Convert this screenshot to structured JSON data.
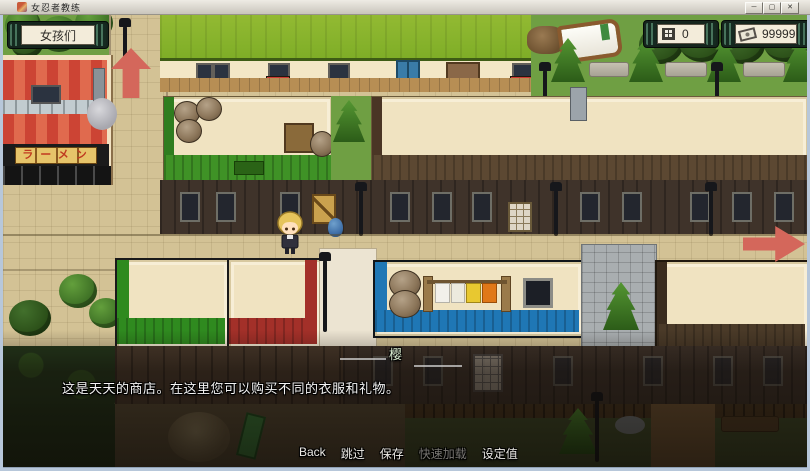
{
  "window": {
    "title": "女忍者教练",
    "minimize_glyph": "─",
    "maximize_glyph": "▢",
    "close_glyph": "✕"
  },
  "hud": {
    "girls_button_label": "女孩们",
    "day_counter": {
      "icon": "calendar-grid-icon",
      "value": "0"
    },
    "money_counter": {
      "icon": "banknote-icon",
      "value": "99999"
    }
  },
  "map": {
    "ramen_sign_text": "ラーメン"
  },
  "dialog": {
    "speaker_name": "樱",
    "text": "这是天天的商店。在这里您可以购买不同的衣服和礼物。"
  },
  "menu": {
    "items": [
      {
        "label": "Back",
        "enabled": true
      },
      {
        "label": "跳过",
        "enabled": true
      },
      {
        "label": "保存",
        "enabled": true
      },
      {
        "label": "快速加载",
        "enabled": false
      },
      {
        "label": "设定值",
        "enabled": true
      }
    ]
  },
  "colors": {
    "arrow_red": "#d4675b",
    "hud_frame": "#15251d",
    "hud_panel": "#f3ecda",
    "roof_green": "#8cb42f",
    "trim_green": "#3f9226",
    "trim_red": "#a33029",
    "trim_blue": "#1f77b5",
    "trim_brown": "#5c4832"
  }
}
